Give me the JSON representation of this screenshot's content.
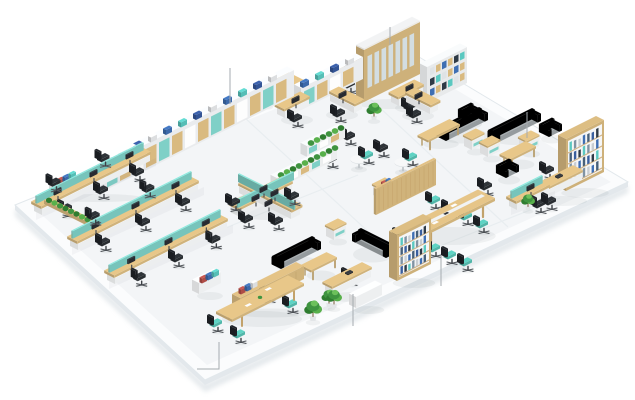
{
  "meta": {
    "label": "Isometric 3D render of an open-plan office floor plan with workstation benches, meeting tables, lounge sofas, bookshelves, plants and callout leader lines pointing at furniture zones"
  },
  "palette": {
    "wood": "#d9ba80",
    "wood_dark": "#c2a26b",
    "teal": "#7fd0c7",
    "seat_teal": "#56c0b2",
    "chair_black": "#2b2f34",
    "sofa": "#9aa0a3",
    "plant_green": "#3f9440",
    "binder": "#3f6fb3",
    "binder_red": "#b8514b",
    "binder_teal": "#5bc8c0",
    "glass": "#d3dde1",
    "white_furniture": "#f4f6f7",
    "floor_top": "#f3f5f7",
    "floor_band": "#fbfcfd",
    "floor_edge": "#e2e8ec",
    "floor_skirt": "#e3e8ec",
    "seam": "#e8edf0",
    "callout": "#a6abb0",
    "background": "#ffffff"
  },
  "floor": {
    "outline": [
      [
        15,
        205
      ],
      [
        404,
        48
      ],
      [
        628,
        182
      ],
      [
        205,
        380
      ]
    ],
    "inner": [
      [
        32,
        206
      ],
      [
        403,
        58
      ],
      [
        611,
        182
      ],
      [
        207,
        365
      ]
    ],
    "skirt": [
      [
        15,
        205
      ],
      [
        205,
        380
      ],
      [
        628,
        182
      ],
      [
        628,
        187
      ],
      [
        205,
        385
      ],
      [
        15,
        210
      ]
    ],
    "shadow": [
      [
        15,
        208
      ],
      [
        205,
        384
      ],
      [
        628,
        185
      ],
      [
        628,
        193
      ],
      [
        205,
        392
      ],
      [
        15,
        216
      ]
    ],
    "seams": [
      [
        [
          245,
          118
        ],
        [
          412,
          272
        ]
      ],
      [
        [
          350,
          80
        ],
        [
          508,
          227
        ]
      ],
      [
        [
          150,
          258
        ],
        [
          358,
          175
        ]
      ],
      [
        [
          430,
          250
        ],
        [
          560,
          198
        ]
      ]
    ]
  },
  "callouts": [
    {
      "points": [
        [
          230,
          68
        ],
        [
          230,
          104
        ]
      ]
    },
    {
      "points": [
        [
          390,
          27
        ],
        [
          390,
          45
        ]
      ]
    },
    {
      "points": [
        [
          527,
          112
        ],
        [
          527,
          138
        ]
      ]
    },
    {
      "points": [
        [
          441,
          256
        ],
        [
          441,
          286
        ]
      ]
    },
    {
      "points": [
        [
          353,
          294
        ],
        [
          353,
          326
        ]
      ]
    },
    {
      "points": [
        [
          219,
          342
        ],
        [
          219,
          369
        ],
        [
          197,
          369
        ]
      ]
    }
  ],
  "items": [
    {
      "t": "whitebox",
      "x": 56,
      "y": 196,
      "len": 80,
      "binders": true
    },
    {
      "t": "wall",
      "x": 104,
      "y": 191,
      "len": 190,
      "h": 26
    },
    {
      "t": "wall",
      "x": 301,
      "y": 110,
      "len": 62,
      "h": 22
    },
    {
      "t": "plant",
      "x": 123,
      "y": 168,
      "s": 0.9
    },
    {
      "t": "plant",
      "x": 268,
      "y": 106,
      "s": 0.9
    },
    {
      "t": "plant",
      "x": 289,
      "y": 97,
      "s": 0.75
    },
    {
      "t": "plant",
      "x": 374,
      "y": 120,
      "s": 1.1
    },
    {
      "t": "tallcab",
      "x": 364,
      "y": 102,
      "len": 56,
      "h": 52
    },
    {
      "t": "bookshelfW",
      "x": 427,
      "y": 103,
      "len": 40,
      "h": 36
    },
    {
      "t": "bench",
      "x": 42,
      "y": 215,
      "len": 108,
      "chairs": 3,
      "back": true
    },
    {
      "t": "bench",
      "x": 78,
      "y": 250,
      "len": 120,
      "chairs": 3,
      "back": true
    },
    {
      "t": "bench",
      "x": 115,
      "y": 284,
      "len": 112,
      "chairs": 3
    },
    {
      "t": "hedge",
      "x": 88,
      "y": 226,
      "len": 44,
      "dir": "B"
    },
    {
      "t": "cluster4",
      "x": 266,
      "y": 210
    },
    {
      "t": "desk",
      "x": 300,
      "y": 97,
      "dir": "B"
    },
    {
      "t": "desk",
      "x": 338,
      "y": 84,
      "dir": "A"
    },
    {
      "t": "desk",
      "x": 285,
      "y": 118,
      "dir": "A"
    },
    {
      "t": "desk",
      "x": 354,
      "y": 113,
      "dir": "B"
    },
    {
      "t": "desk",
      "x": 399,
      "y": 106,
      "dir": "A"
    },
    {
      "t": "desk",
      "x": 430,
      "y": 114,
      "dir": "B"
    },
    {
      "t": "hedgewall",
      "x": 277,
      "y": 189,
      "len": 60
    },
    {
      "t": "hedgewall",
      "x": 307,
      "y": 157,
      "len": 38
    },
    {
      "t": "roundtable",
      "x": 359,
      "y": 168
    },
    {
      "t": "chair",
      "x": 369,
      "y": 161,
      "teal": true
    },
    {
      "t": "roundtable",
      "x": 403,
      "y": 171
    },
    {
      "t": "chair",
      "x": 413,
      "y": 163,
      "teal": true
    },
    {
      "t": "chair",
      "x": 351,
      "y": 142
    },
    {
      "t": "chair",
      "x": 333,
      "y": 165
    },
    {
      "t": "chair",
      "x": 384,
      "y": 154
    },
    {
      "t": "armchair",
      "x": 468,
      "y": 122
    },
    {
      "t": "sofa",
      "x": 446,
      "y": 141,
      "len": 42,
      "dir": "A"
    },
    {
      "t": "coffeetable",
      "x": 428,
      "y": 149,
      "len": 32
    },
    {
      "t": "sidetable",
      "x": 472,
      "y": 150
    },
    {
      "t": "sofa",
      "x": 497,
      "y": 143,
      "len": 44,
      "dir": "A"
    },
    {
      "t": "armchair",
      "x": 549,
      "y": 137
    },
    {
      "t": "sidetable",
      "x": 488,
      "y": 157
    },
    {
      "t": "sidetable",
      "x": 527,
      "y": 152
    },
    {
      "t": "coffeetable",
      "x": 510,
      "y": 168,
      "len": 26
    },
    {
      "t": "armchair",
      "x": 506,
      "y": 178
    },
    {
      "t": "chair",
      "x": 488,
      "y": 192
    },
    {
      "t": "bookshelf",
      "x": 566,
      "y": 191,
      "len": 38,
      "h": 52
    },
    {
      "t": "chair",
      "x": 550,
      "y": 176
    },
    {
      "t": "execdesk",
      "x": 542,
      "y": 200,
      "len": 40
    },
    {
      "t": "chair",
      "x": 552,
      "y": 207
    },
    {
      "t": "bench",
      "x": 517,
      "y": 210,
      "len": 32,
      "chairs": 1
    },
    {
      "t": "plant",
      "x": 528,
      "y": 210,
      "s": 1.0
    },
    {
      "t": "partition",
      "x": 376,
      "y": 215,
      "len": 60,
      "h": 26
    },
    {
      "t": "sidetable",
      "x": 381,
      "y": 199,
      "binders": true
    },
    {
      "t": "conftable",
      "x": 419,
      "y": 249,
      "len": 76,
      "dep": 17
    },
    {
      "t": "chair",
      "x": 436,
      "y": 206,
      "teal": true
    },
    {
      "t": "chair",
      "x": 452,
      "y": 214,
      "teal": true
    },
    {
      "t": "chair",
      "x": 468,
      "y": 222,
      "teal": true
    },
    {
      "t": "chair",
      "x": 484,
      "y": 230,
      "teal": true
    },
    {
      "t": "chair",
      "x": 403,
      "y": 242,
      "teal": true
    },
    {
      "t": "chair",
      "x": 419,
      "y": 248,
      "teal": true
    },
    {
      "t": "chair",
      "x": 436,
      "y": 254,
      "teal": true
    },
    {
      "t": "chair",
      "x": 452,
      "y": 261,
      "teal": true
    },
    {
      "t": "chair",
      "x": 468,
      "y": 268,
      "teal": true
    },
    {
      "t": "bookshelf",
      "x": 397,
      "y": 281,
      "len": 34,
      "h": 46
    },
    {
      "t": "execdesk",
      "x": 333,
      "y": 296,
      "len": 38
    },
    {
      "t": "chair",
      "x": 352,
      "y": 282
    },
    {
      "t": "whitebox",
      "x": 356,
      "y": 308,
      "len": 26
    },
    {
      "t": "plant",
      "x": 329,
      "y": 307,
      "s": 1.1
    },
    {
      "t": "whitebox",
      "x": 199,
      "y": 294,
      "len": 22,
      "binders": true
    },
    {
      "t": "credenza",
      "x": 240,
      "y": 311,
      "len": 64
    },
    {
      "t": "meettable",
      "x": 232,
      "y": 331,
      "len": 72,
      "dep": 16
    },
    {
      "t": "chair",
      "x": 270,
      "y": 299,
      "teal": true
    },
    {
      "t": "chair",
      "x": 293,
      "y": 310,
      "teal": true
    },
    {
      "t": "chair",
      "x": 218,
      "y": 329,
      "teal": true
    },
    {
      "t": "chair",
      "x": 241,
      "y": 340,
      "teal": true
    },
    {
      "t": "plant",
      "x": 313,
      "y": 321,
      "s": 1.3
    },
    {
      "t": "plant",
      "x": 334,
      "y": 308,
      "s": 1.15
    },
    {
      "t": "sofa",
      "x": 281,
      "y": 269,
      "len": 40,
      "dir": "A"
    },
    {
      "t": "coffeetable",
      "x": 311,
      "y": 279,
      "len": 26
    },
    {
      "t": "sofa",
      "x": 386,
      "y": 258,
      "len": 34,
      "dir": "B"
    },
    {
      "t": "sidetable",
      "x": 334,
      "y": 240
    }
  ]
}
